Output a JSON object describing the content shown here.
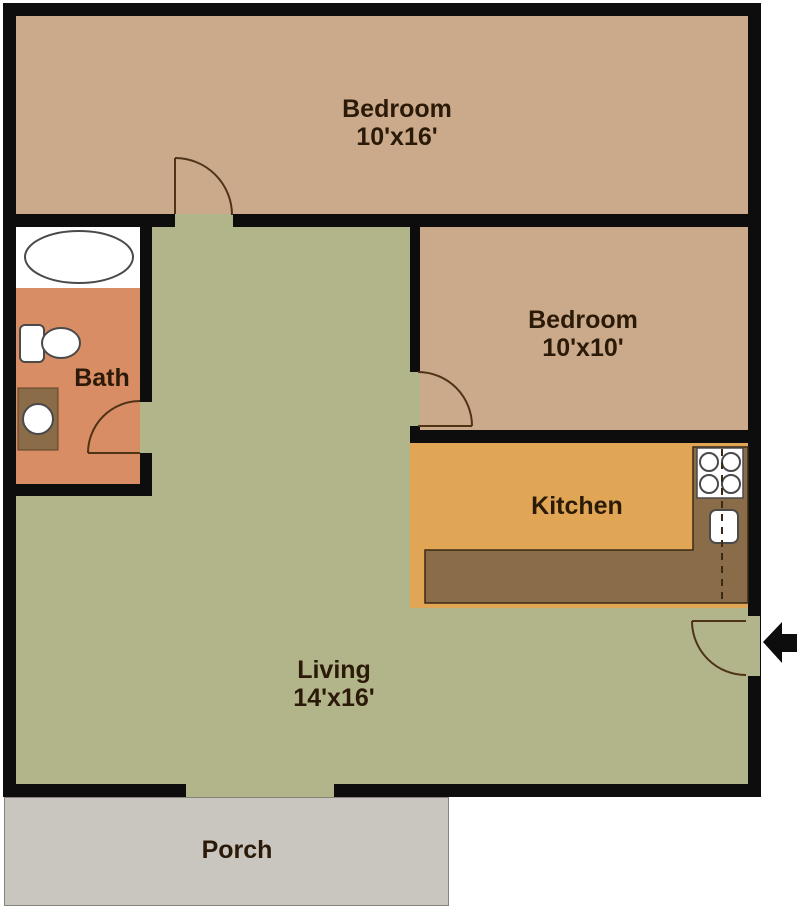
{
  "title": "Apartment floor plan",
  "rooms": {
    "bedroom_large": {
      "label": "Bedroom",
      "size": "10'x16'"
    },
    "bedroom_small": {
      "label": "Bedroom",
      "size": "10'x10'"
    },
    "bath": {
      "label": "Bath"
    },
    "kitchen": {
      "label": "Kitchen"
    },
    "living": {
      "label": "Living",
      "size": "14'x16'"
    },
    "porch": {
      "label": "Porch"
    }
  },
  "fixtures": [
    "bathtub",
    "toilet",
    "vanity-sink",
    "kitchen-counter",
    "stove",
    "kitchen-sink",
    "entry-door-arrow",
    "door-bedroom-large",
    "door-bedroom-small",
    "door-bath",
    "door-entry"
  ],
  "colors": {
    "wall": "#0d0d0d",
    "bedroom_floor": "#cbaa8c",
    "living_floor": "#b2b48a",
    "kitchen_floor": "#e0a655",
    "bath_floor": "#d98d64",
    "counter": "#8a6c48",
    "porch": "#c9c6bf",
    "fixture_outline": "#4a4a4a",
    "door_arc": "#4f3317",
    "label_text": "#2b1a08",
    "outside": "#ffffff"
  }
}
